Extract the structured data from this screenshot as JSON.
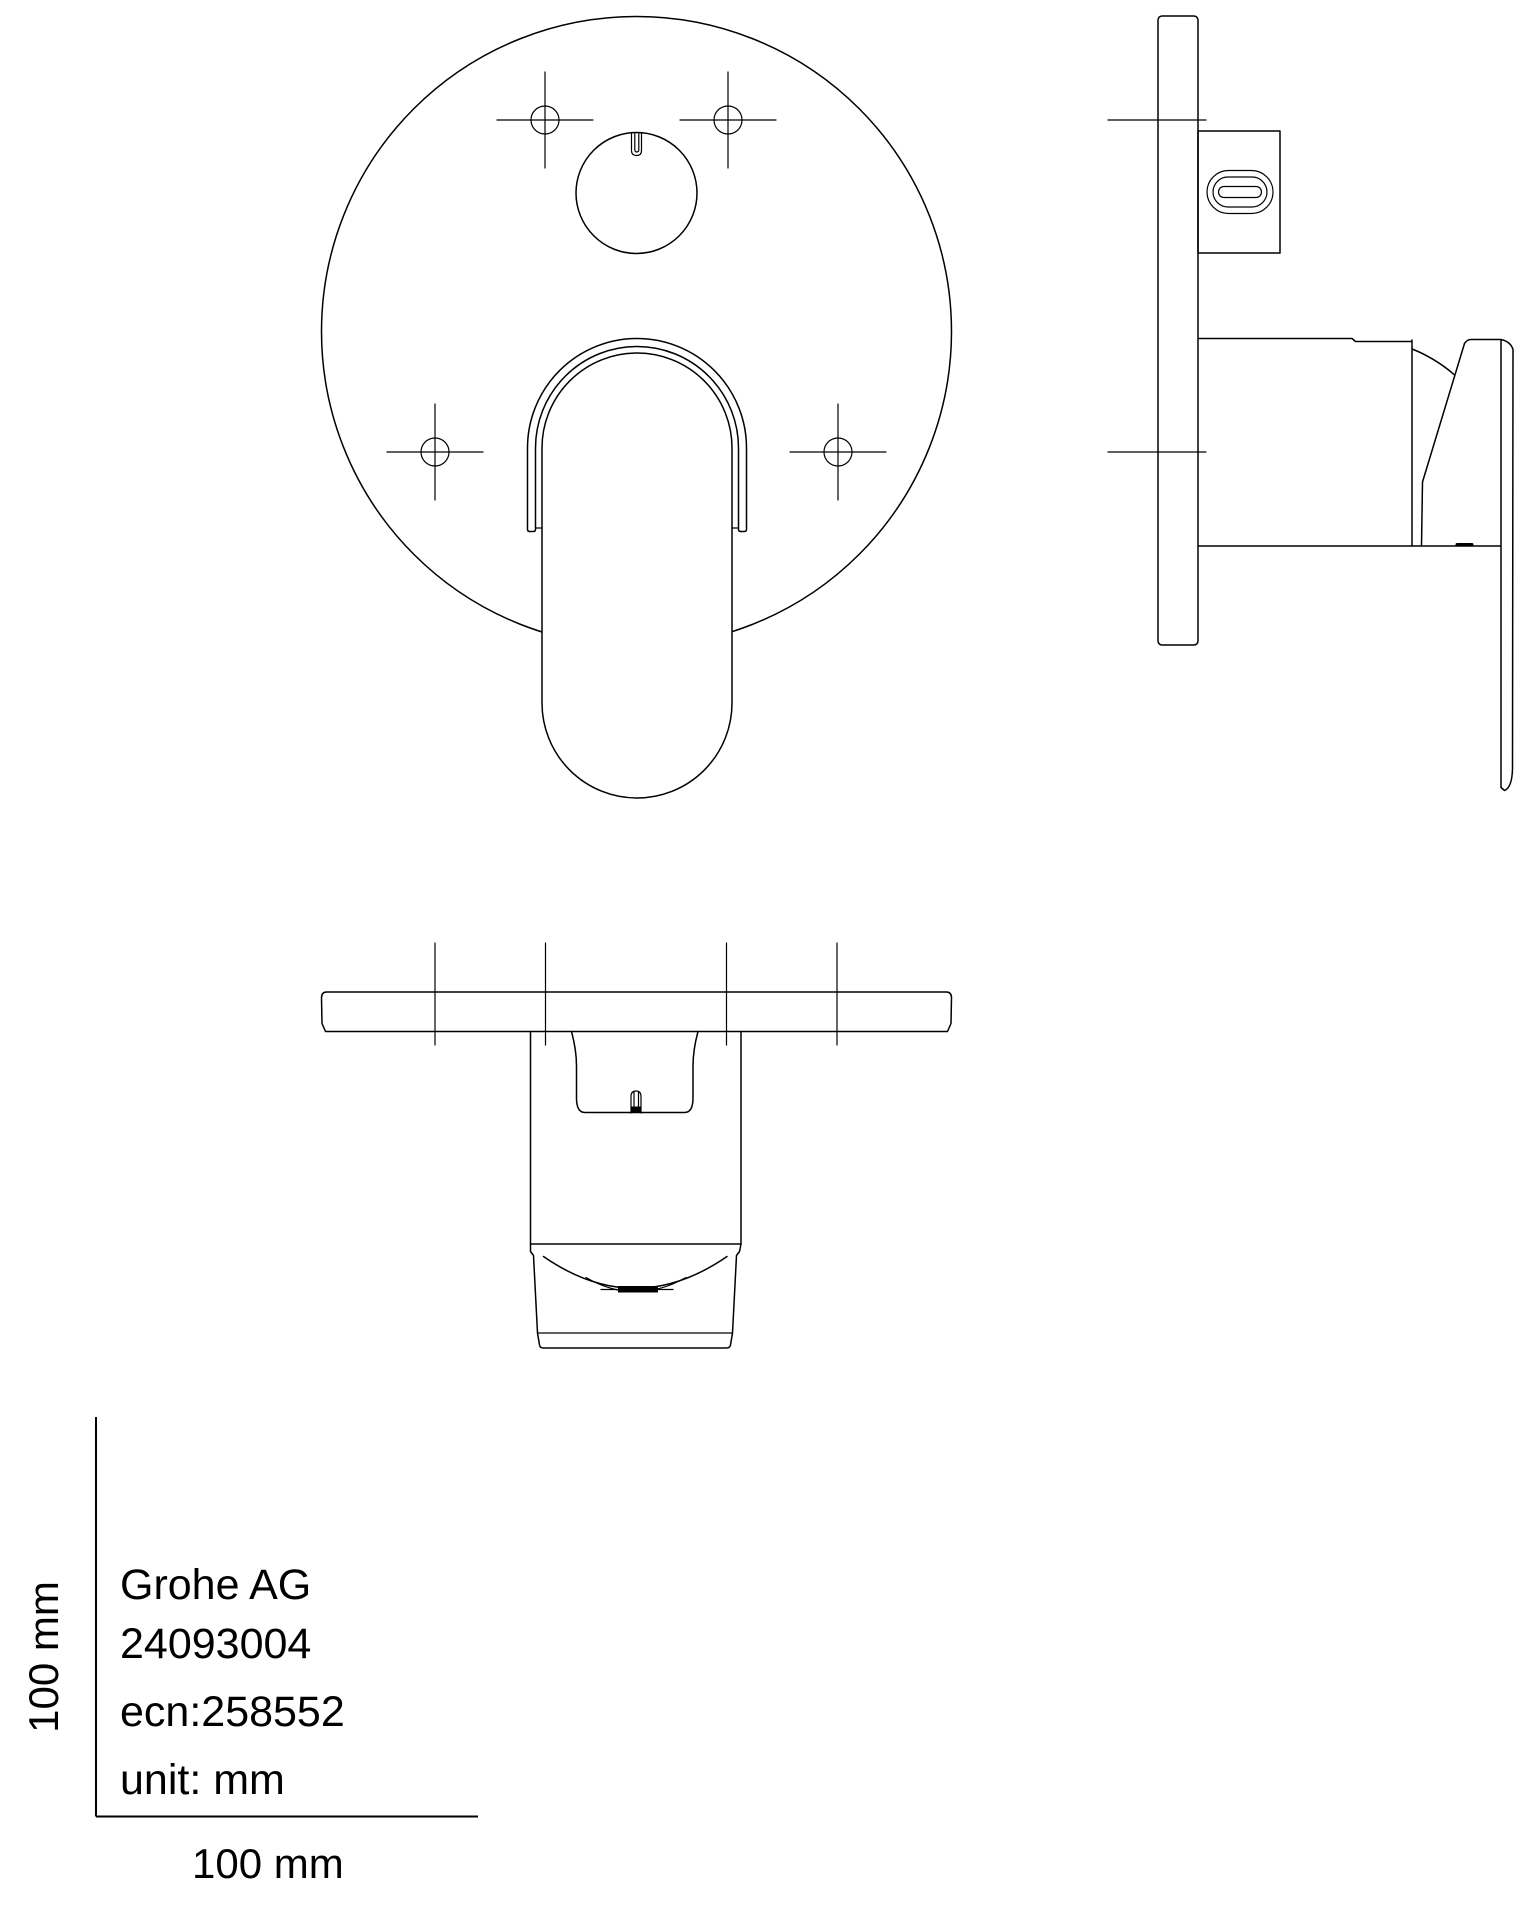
{
  "drawing": {
    "manufacturer": "Grohe AG",
    "product_number": "24093004",
    "ecn": "ecn:258552",
    "unit_label": "unit: mm",
    "scale_x_label": "100 mm",
    "scale_y_label": "100 mm",
    "line_color": "#000000",
    "background_color": "#ffffff"
  }
}
